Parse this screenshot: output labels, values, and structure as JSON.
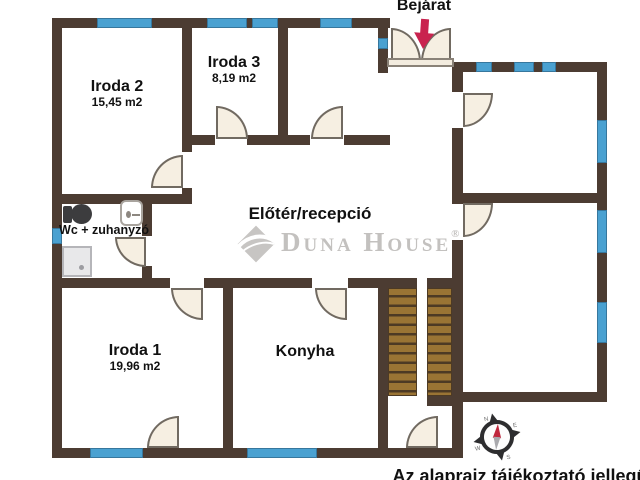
{
  "entrance": {
    "label": "Bejárat"
  },
  "rooms": {
    "iroda2": {
      "name": "Iroda 2",
      "area": "15,45 m2"
    },
    "iroda3": {
      "name": "Iroda 3",
      "area": "8,19 m2"
    },
    "eloter": {
      "name": "Előtér/recepció"
    },
    "wc": {
      "name": "Wc + zuhanyzó"
    },
    "iroda1": {
      "name": "Iroda 1",
      "area": "19,96 m2"
    },
    "konyha": {
      "name": "Konyha"
    }
  },
  "watermark": {
    "brand": "Duna House",
    "registered": "®"
  },
  "compass": {
    "north": "N",
    "east": "E",
    "south": "S",
    "west": "W"
  },
  "footer": {
    "disclaimer": "Az alaprajz tájékoztató jellegű!"
  },
  "colors": {
    "wall": "#4c3c32",
    "window_blue": "#4aa1d1",
    "door_fill": "#f6efe2",
    "stair_wood": "#9a7434",
    "entrance_arrow_red": "#c9234f",
    "watermark_gray": "#c3c1bf"
  }
}
